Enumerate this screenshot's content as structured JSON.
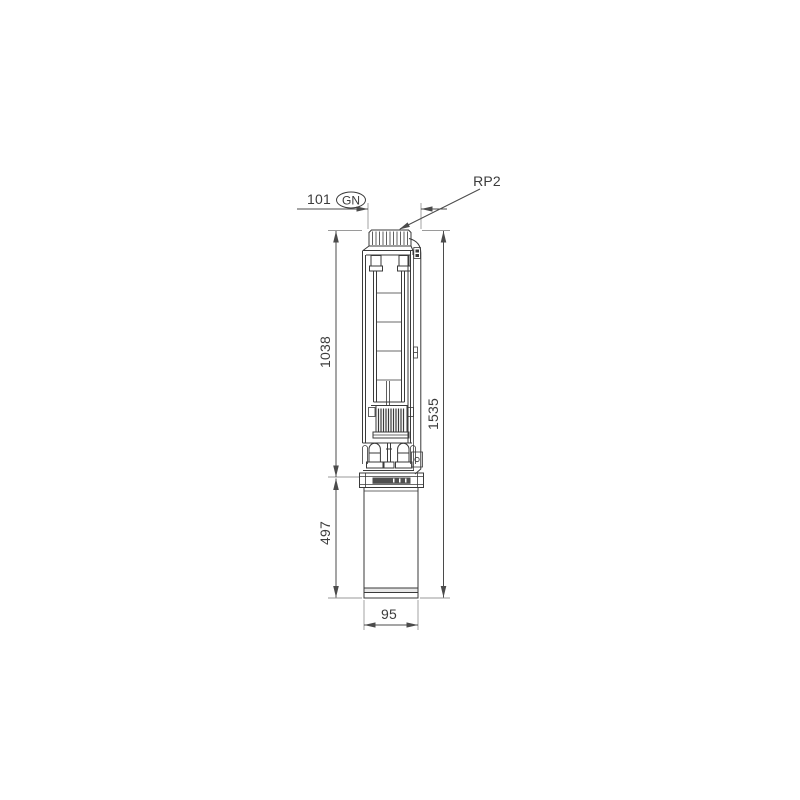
{
  "drawing": {
    "labels": {
      "connection_thread": "RP2",
      "top_width": "101",
      "variant_badge": "GN",
      "pump_end_length": "1038",
      "motor_length": "497",
      "total_length": "1535",
      "motor_diameter": "95"
    },
    "colors": {
      "line": "#3a3a3a",
      "dim": "#4b4b4b",
      "ext": "#9a9a9a",
      "text": "#3c3c3c",
      "nameplate": "#4f4f4f",
      "band": "#e7e7e7",
      "background": "#ffffff"
    }
  }
}
